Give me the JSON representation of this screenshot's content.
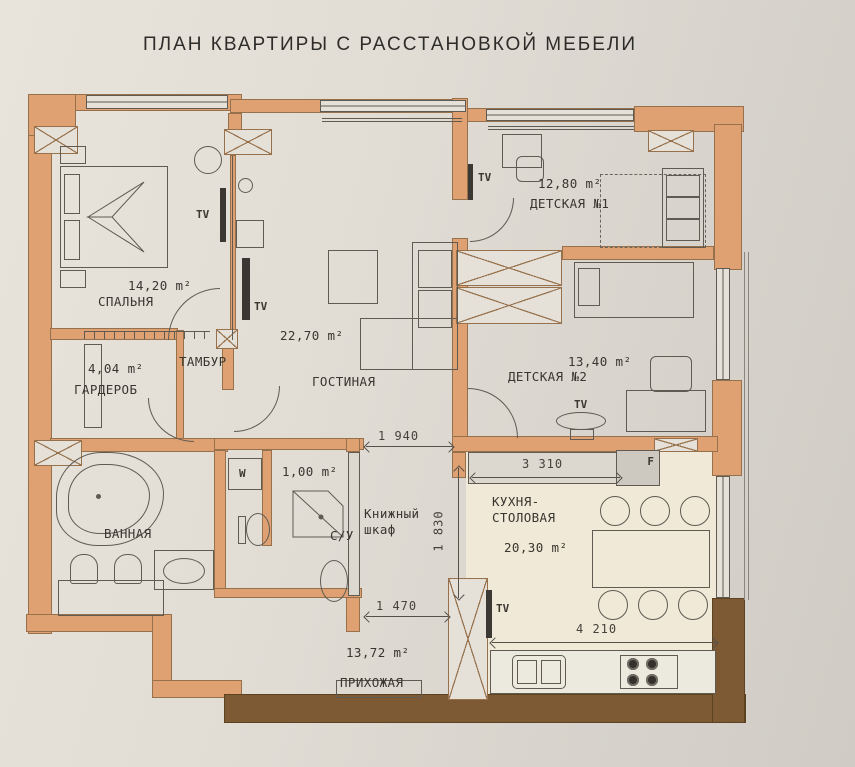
{
  "title": "ПЛАН КВАРТИРЫ С РАССТАНОВКОЙ МЕБЕЛИ",
  "rooms": {
    "bedroom": {
      "name": "СПАЛЬНЯ",
      "area": "14,20 m²"
    },
    "wardrobe": {
      "name": "ГАРДЕРОБ",
      "area": "4,04 m²"
    },
    "tambur": {
      "name": "ТАМБУР"
    },
    "living": {
      "name": "ГОСТИНАЯ",
      "area": "22,70 m²"
    },
    "kids1": {
      "name": "ДЕТСКАЯ №1",
      "area": "12,80 m²"
    },
    "kids2": {
      "name": "ДЕТСКАЯ №2",
      "area": "13,40 m²"
    },
    "bath": {
      "name": "ВАННАЯ"
    },
    "shower_wc": {
      "name": "С/У",
      "area": "1,00 m²"
    },
    "kitchen": {
      "name": "КУХНЯ-СТОЛОВАЯ",
      "area": "20,30 m²"
    },
    "hallway": {
      "name": "ПРИХОЖАЯ",
      "area": "13,72 m²"
    },
    "bookcase": {
      "name": "Книжный шкаф"
    }
  },
  "appliance_labels": {
    "tv": "TV",
    "washer": "W",
    "fridge": "F"
  },
  "dimensions_mm": {
    "corridor_top": "1 940",
    "kitchen_counter": "3 310",
    "kitchen_opening": "1 830",
    "corridor_bottom": "1 470",
    "kitchen_width": "4 210"
  },
  "colors": {
    "wall": "#dfa172",
    "wall_dark": "#7d5a33",
    "paper": "#e5e1d9",
    "kitchen_floor": "#f0e9d8",
    "line": "#5f5b53"
  }
}
